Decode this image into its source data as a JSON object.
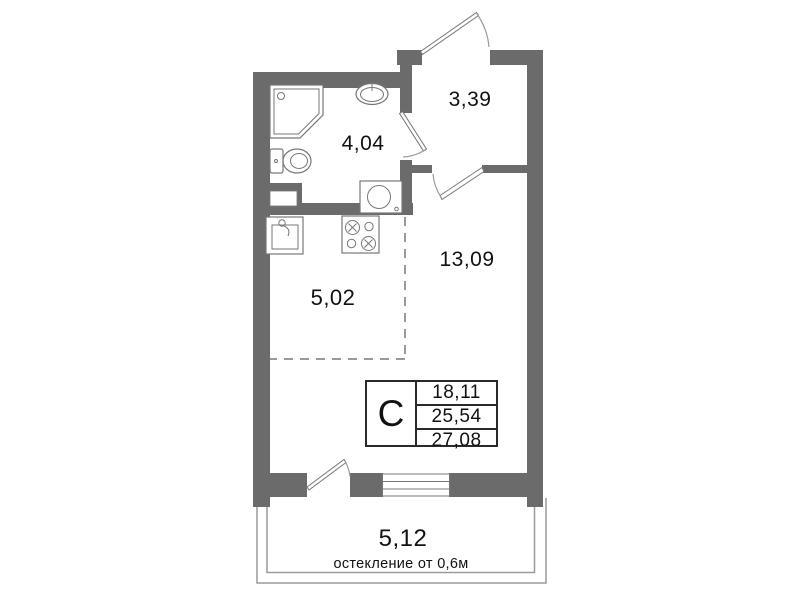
{
  "colors": {
    "wall": "#6b6b6b",
    "line": "#777777",
    "linelight": "#9a9a9a",
    "text": "#111111"
  },
  "rooms": {
    "hall": {
      "area": "3,39"
    },
    "bathroom": {
      "area": "4,04"
    },
    "living": {
      "area": "13,09"
    },
    "kitchen": {
      "area": "5,02"
    },
    "balcony": {
      "area": "5,12",
      "note": "остекление от 0,6м"
    }
  },
  "info_table": {
    "type": "С",
    "values": [
      "18,11",
      "25,54",
      "27,08"
    ]
  }
}
